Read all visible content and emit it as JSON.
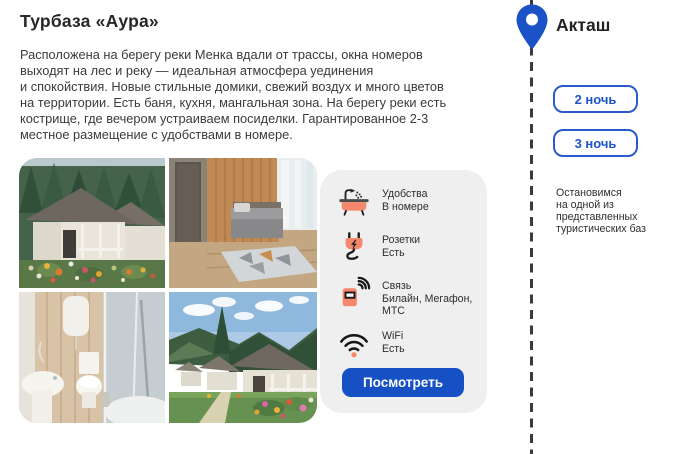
{
  "title": "Турбаза «Аура»",
  "description_lines": [
    "Расположена на берегу реки Менка вдали от трассы, окна номеров",
    "выходят на лес и реку — идеальная атмосфера уединения",
    "и спокойствия. Новые стильные домики, свежий воздух и много цветов",
    "на территории. Есть баня, кухня, мангальная зона. На берегу реки есть",
    "кострище, где вечером устраиваем посиделки. Гарантированное 2-3",
    "местное размещение с удобствами в номере."
  ],
  "photos": [
    {
      "name": "cabins-exterior-with-flowers"
    },
    {
      "name": "bedroom-interior"
    },
    {
      "name": "bathroom"
    },
    {
      "name": "cabins-row-with-mountains"
    }
  ],
  "amenities": {
    "items": [
      {
        "icon": "shower-bath-icon",
        "title": "Удобства",
        "value": "В номере"
      },
      {
        "icon": "power-plug-icon",
        "title": "Розетки",
        "value": "Есть"
      },
      {
        "icon": "mobile-signal-icon",
        "title": "Связь",
        "value": "Билайн, Мегафон, МТС"
      },
      {
        "icon": "wifi-icon",
        "title": "WiFi",
        "value": "Есть"
      }
    ],
    "view_button": "Посмотреть"
  },
  "route": {
    "location": "Акташ",
    "nights_options": [
      "2 ночь",
      "3 ночь"
    ],
    "note": "Остановимся\nна одной из\nпредставленных\nтуристических баз"
  },
  "colors": {
    "accent_blue": "#1b52c8",
    "button_blue": "#1550c4",
    "coral": "#f5876c",
    "panel_gray": "#efefef",
    "dash_line": "#3b3b3b",
    "text_dark": "#3b3b3b"
  }
}
